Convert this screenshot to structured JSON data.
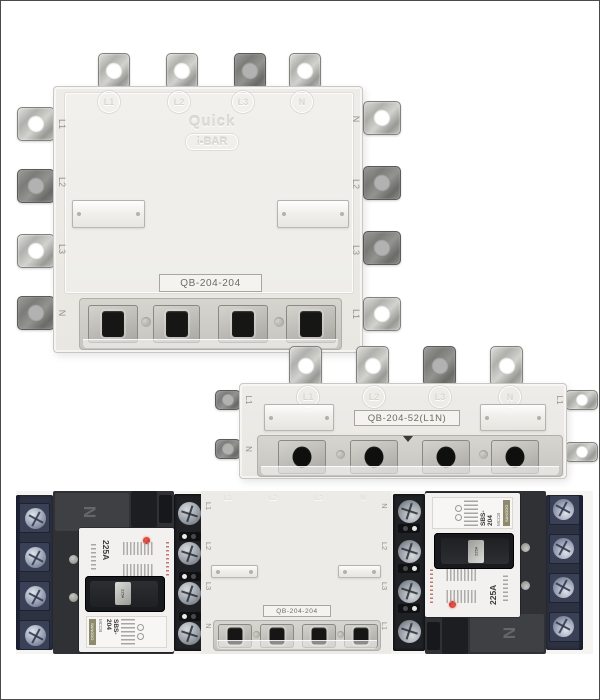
{
  "page": {
    "background": "#ffffff",
    "border_color": "#4a4a4a"
  },
  "top_unit": {
    "model_label": "QB-204-204",
    "brand_line1": "Quick",
    "brand_line2": "i-BAR",
    "top_terminals": [
      "L1",
      "L2",
      "L3",
      "N"
    ],
    "left_terminals": [
      "L1",
      "L2",
      "L3",
      "N"
    ],
    "right_terminals": [
      "N",
      "L2",
      "L3",
      "L1"
    ]
  },
  "middle_unit": {
    "model_label": "QB-204-52(L1N)",
    "face_terminals": [
      "L1",
      "L2",
      "L3",
      "N"
    ],
    "left_tab_terminals": [
      "L1",
      "N"
    ],
    "right_tab_terminals": [
      "L1",
      "N"
    ]
  },
  "photo": {
    "center_unit": {
      "model_label": "QB-204-204",
      "top_terminals": [
        "L1",
        "L2",
        "L3",
        "N"
      ],
      "left_terminals": [
        "L1",
        "L2",
        "L3",
        "N"
      ],
      "right_terminals": [
        "N",
        "L2",
        "L3",
        "L1"
      ]
    },
    "breaker": {
      "neutral_mark": "N",
      "rating": "225A",
      "handle_tag": "225A",
      "brand": "SANGDO",
      "type": "MCCB",
      "model": "SBS-204"
    }
  },
  "colors": {
    "busbar_body": "#eceae6",
    "metal": "#c2c2be",
    "breaker_housing": "#2f3135",
    "terminal_block_navy": "#2d3242",
    "indicator_red": "#d3261f",
    "face_white": "#f2f1ef"
  }
}
